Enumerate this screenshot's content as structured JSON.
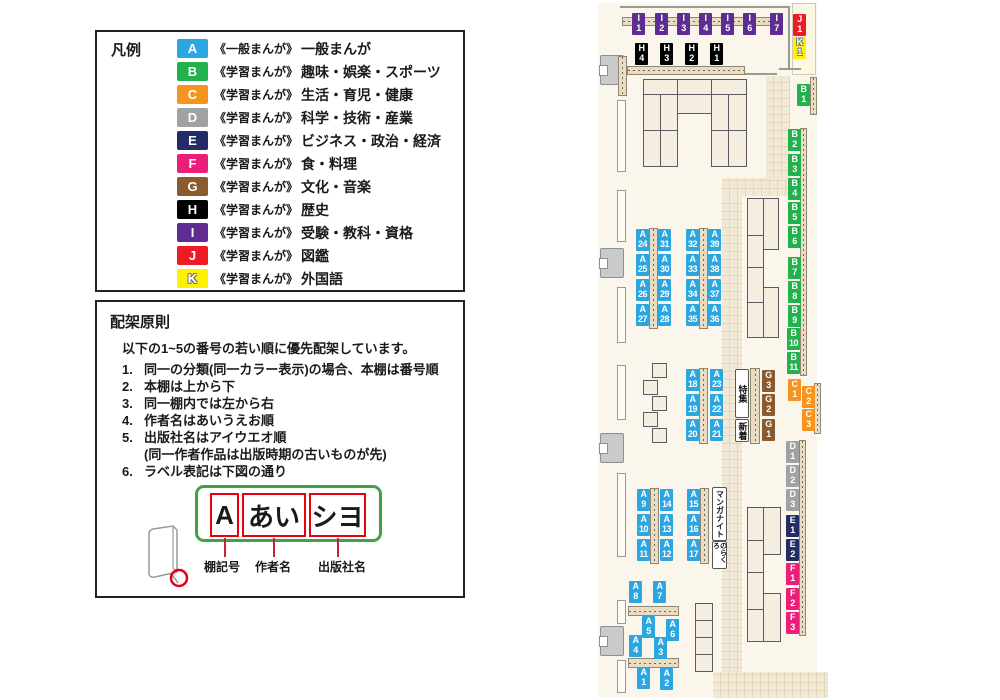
{
  "legend": {
    "title": "凡例",
    "items": [
      {
        "code": "A",
        "color": "#2CA6E0",
        "category": "《一般まんが》",
        "label": "一般まんが"
      },
      {
        "code": "B",
        "color": "#22B14C",
        "category": "《学習まんが》",
        "label": "趣味・娯楽・スポーツ"
      },
      {
        "code": "C",
        "color": "#F7941D",
        "category": "《学習まんが》",
        "label": "生活・育児・健康"
      },
      {
        "code": "D",
        "color": "#A0A1A3",
        "category": "《学習まんが》",
        "label": "科学・技術・産業"
      },
      {
        "code": "E",
        "color": "#232C66",
        "category": "《学習まんが》",
        "label": "ビジネス・政治・経済"
      },
      {
        "code": "F",
        "color": "#EB1E79",
        "category": "《学習まんが》",
        "label": "食・料理"
      },
      {
        "code": "G",
        "color": "#8A5B2E",
        "category": "《学習まんが》",
        "label": "文化・音楽"
      },
      {
        "code": "H",
        "color": "#000000",
        "category": "《学習まんが》",
        "label": "歴史"
      },
      {
        "code": "I",
        "color": "#5F2D91",
        "category": "《学習まんが》",
        "label": "受験・教科・資格"
      },
      {
        "code": "J",
        "color": "#EC1B24",
        "category": "《学習まんが》",
        "label": "図鑑"
      },
      {
        "code": "K",
        "color": "#FFF100",
        "category": "《学習まんが》",
        "label": "外国語",
        "outlined": true
      }
    ]
  },
  "principles": {
    "title": "配架原則",
    "intro": "以下の1~5の番号の若い順に優先配架しています。",
    "rules": [
      {
        "num": "1.",
        "text": "同一の分類(同一カラー表示)の場合、本棚は番号順"
      },
      {
        "num": "2.",
        "text": "本棚は上から下"
      },
      {
        "num": "3.",
        "text": "同一棚内では左から右"
      },
      {
        "num": "4.",
        "text": "作者名はあいうえお順"
      },
      {
        "num": "5.",
        "text": "出版社名はアイウエオ順",
        "sub": "(同一作者作品は出版時期の古いものが先)"
      },
      {
        "num": "6.",
        "text": "ラベル表記は下図の通り"
      }
    ],
    "label_example": {
      "shelf_code": "A",
      "author": "あい",
      "publisher": "シヨ",
      "captions": [
        "棚記号",
        "作者名",
        "出版社名"
      ]
    }
  },
  "map": {
    "signs": {
      "tokushu": "特集",
      "shinchaku": "新着",
      "manga_night": "マンガナイト",
      "norakuro": "のらくろ"
    },
    "shelf_labels": [
      {
        "id": "I1",
        "x": 632,
        "y": 13
      },
      {
        "id": "I2",
        "x": 655,
        "y": 13
      },
      {
        "id": "I3",
        "x": 677,
        "y": 13
      },
      {
        "id": "I4",
        "x": 699,
        "y": 13
      },
      {
        "id": "I5",
        "x": 721,
        "y": 13
      },
      {
        "id": "I6",
        "x": 743,
        "y": 13
      },
      {
        "id": "I7",
        "x": 770,
        "y": 13
      },
      {
        "id": "J1",
        "x": 793,
        "y": 14
      },
      {
        "id": "K1",
        "x": 793,
        "y": 37
      },
      {
        "id": "H4",
        "x": 635,
        "y": 43
      },
      {
        "id": "H3",
        "x": 660,
        "y": 43
      },
      {
        "id": "H2",
        "x": 685,
        "y": 43
      },
      {
        "id": "H1",
        "x": 710,
        "y": 43
      },
      {
        "id": "B1",
        "x": 797,
        "y": 84
      },
      {
        "id": "B2",
        "x": 788,
        "y": 129
      },
      {
        "id": "B3",
        "x": 788,
        "y": 154
      },
      {
        "id": "B4",
        "x": 788,
        "y": 178
      },
      {
        "id": "B5",
        "x": 788,
        "y": 202
      },
      {
        "id": "B6",
        "x": 788,
        "y": 226
      },
      {
        "id": "B7",
        "x": 788,
        "y": 257
      },
      {
        "id": "B8",
        "x": 788,
        "y": 281
      },
      {
        "id": "B9",
        "x": 788,
        "y": 305
      },
      {
        "id": "B10",
        "x": 787,
        "y": 328
      },
      {
        "id": "B11",
        "x": 787,
        "y": 352
      },
      {
        "id": "C1",
        "x": 788,
        "y": 379
      },
      {
        "id": "C2",
        "x": 802,
        "y": 386
      },
      {
        "id": "C3",
        "x": 802,
        "y": 409
      },
      {
        "id": "D1",
        "x": 786,
        "y": 441
      },
      {
        "id": "D2",
        "x": 786,
        "y": 465
      },
      {
        "id": "D3",
        "x": 786,
        "y": 489
      },
      {
        "id": "E1",
        "x": 786,
        "y": 515
      },
      {
        "id": "E2",
        "x": 786,
        "y": 539
      },
      {
        "id": "F1",
        "x": 786,
        "y": 563
      },
      {
        "id": "F2",
        "x": 786,
        "y": 588
      },
      {
        "id": "F3",
        "x": 786,
        "y": 612
      },
      {
        "id": "G3",
        "x": 762,
        "y": 370
      },
      {
        "id": "G2",
        "x": 762,
        "y": 394
      },
      {
        "id": "G1",
        "x": 762,
        "y": 419
      },
      {
        "id": "A24",
        "x": 636,
        "y": 229
      },
      {
        "id": "A31",
        "x": 658,
        "y": 229
      },
      {
        "id": "A25",
        "x": 636,
        "y": 254
      },
      {
        "id": "A30",
        "x": 658,
        "y": 254
      },
      {
        "id": "A26",
        "x": 636,
        "y": 279
      },
      {
        "id": "A29",
        "x": 658,
        "y": 279
      },
      {
        "id": "A27",
        "x": 636,
        "y": 304
      },
      {
        "id": "A28",
        "x": 658,
        "y": 304
      },
      {
        "id": "A32",
        "x": 686,
        "y": 229
      },
      {
        "id": "A39",
        "x": 708,
        "y": 229
      },
      {
        "id": "A33",
        "x": 686,
        "y": 254
      },
      {
        "id": "A38",
        "x": 708,
        "y": 254
      },
      {
        "id": "A34",
        "x": 686,
        "y": 279
      },
      {
        "id": "A37",
        "x": 708,
        "y": 279
      },
      {
        "id": "A35",
        "x": 686,
        "y": 304
      },
      {
        "id": "A36",
        "x": 708,
        "y": 304
      },
      {
        "id": "A18",
        "x": 686,
        "y": 369
      },
      {
        "id": "A23",
        "x": 710,
        "y": 369
      },
      {
        "id": "A19",
        "x": 686,
        "y": 394
      },
      {
        "id": "A22",
        "x": 710,
        "y": 394
      },
      {
        "id": "A20",
        "x": 686,
        "y": 419
      },
      {
        "id": "A21",
        "x": 710,
        "y": 419
      },
      {
        "id": "A9",
        "x": 637,
        "y": 489
      },
      {
        "id": "A14",
        "x": 660,
        "y": 489
      },
      {
        "id": "A10",
        "x": 637,
        "y": 514
      },
      {
        "id": "A13",
        "x": 660,
        "y": 514
      },
      {
        "id": "A11",
        "x": 637,
        "y": 539
      },
      {
        "id": "A12",
        "x": 660,
        "y": 539
      },
      {
        "id": "A15",
        "x": 687,
        "y": 489
      },
      {
        "id": "A16",
        "x": 687,
        "y": 514
      },
      {
        "id": "A17",
        "x": 687,
        "y": 539
      },
      {
        "id": "A8",
        "x": 629,
        "y": 581
      },
      {
        "id": "A7",
        "x": 653,
        "y": 581
      },
      {
        "id": "A5",
        "x": 642,
        "y": 616
      },
      {
        "id": "A6",
        "x": 666,
        "y": 619
      },
      {
        "id": "A4",
        "x": 629,
        "y": 635
      },
      {
        "id": "A3",
        "x": 654,
        "y": 637
      },
      {
        "id": "A1",
        "x": 637,
        "y": 667
      },
      {
        "id": "A2",
        "x": 660,
        "y": 668
      }
    ]
  }
}
